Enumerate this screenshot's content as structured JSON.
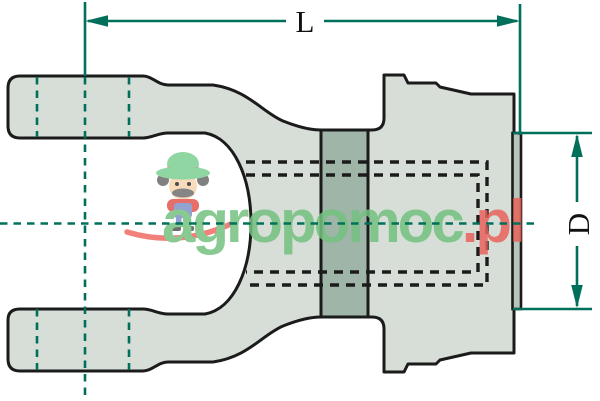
{
  "drawing": {
    "description": "Technical outline drawing of a PTO drive shaft yoke with overall length and bore diameter dimensions",
    "labels": {
      "length": "L",
      "diameter": "D"
    },
    "colors": {
      "dimension_line": "#00705a",
      "outline": "#1b1b1b",
      "part_fill": "#d6ded7",
      "collar_fill": "#9fb5a8",
      "end_strip_fill": "#b7c6ba",
      "background": "#ffffff"
    }
  },
  "watermark": {
    "brand_green": "agropomoc",
    "brand_red": ".pl",
    "text_green_color": "#74c17f",
    "text_red_color": "#e8635c",
    "mascot": "farmer-mascot"
  }
}
